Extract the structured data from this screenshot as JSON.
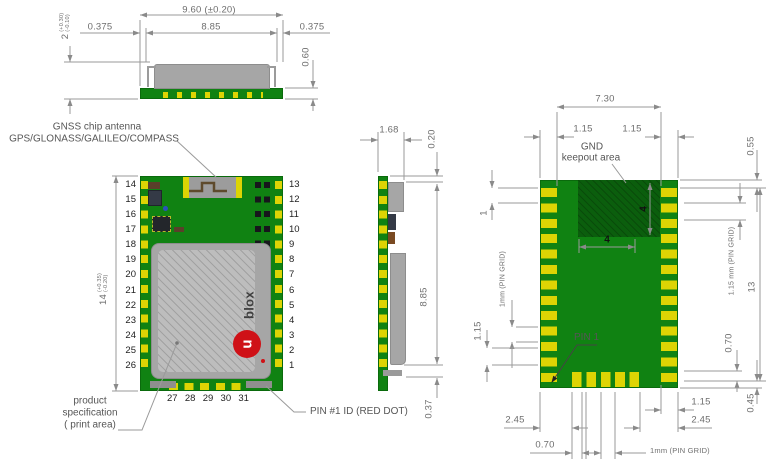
{
  "front_view": {
    "dim_overall": "9.60 (±0.20)",
    "dim_left": "0.375",
    "dim_center": "8.85",
    "dim_right": "0.375",
    "dim_height": "0.60",
    "dim_thickness_value": "2",
    "dim_thickness_tol_plus": "(+0.30)",
    "dim_thickness_tol_minus": "(-0.10)"
  },
  "top_view": {
    "antenna_label_1": "GNSS chip antenna",
    "antenna_label_2": "GPS/GLONASS/GALILEO/COMPASS",
    "left_pins": [
      "14",
      "15",
      "16",
      "17",
      "18",
      "19",
      "20",
      "21",
      "22",
      "23",
      "24",
      "25",
      "26"
    ],
    "right_pins": [
      "13",
      "12",
      "11",
      "10",
      "9",
      "8",
      "7",
      "6",
      "5",
      "4",
      "3",
      "2",
      "1"
    ],
    "bottom_pins": [
      "27",
      "28",
      "29",
      "30",
      "31"
    ],
    "dim_height_value": "14",
    "dim_height_tol_plus": "(+0.35)",
    "dim_height_tol_minus": "(-0.20)",
    "logo_text": "blox",
    "logo_u": "u",
    "print_label_1": "product",
    "print_label_2": "specification",
    "print_label_3": "( print area)",
    "pin1_label": "PIN #1 ID (RED DOT)"
  },
  "side_view": {
    "dim_width": "1.68",
    "dim_top": "0.20",
    "dim_body": "8.85",
    "dim_bottom": "0.37"
  },
  "bottom_view": {
    "dim_top_width": "7.30",
    "dim_top_left": "1.15",
    "dim_top_right": "1.15",
    "gnd_label_1": "GND",
    "gnd_label_2": "keepout area",
    "dim_keepout_h": "4",
    "dim_keepout_w": "4",
    "dim_corner": "0.55",
    "dim_first_pitch": "1",
    "dim_left_grid": "1mm (PIN GRID)",
    "dim_left_115": "1.15",
    "pin1_label": "PIN 1",
    "dim_right_grid": "1.15 mm (PIN GRID)",
    "dim_right_height": "13",
    "dim_right_070": "0.70",
    "dim_right_045": "0.45",
    "dim_bot_245_left": "2.45",
    "dim_bot_070": "0.70",
    "dim_bot_115": "1.15",
    "dim_bot_245_right": "2.45",
    "dim_bot_grid": "1mm (PIN GRID)"
  },
  "colors": {
    "pcb_green": "#108212",
    "keepout_green": "#0b5e0d",
    "pad_yellow": "#ddd404",
    "shield_gray": "#a6a6a6",
    "logo_red": "#cf1117"
  }
}
